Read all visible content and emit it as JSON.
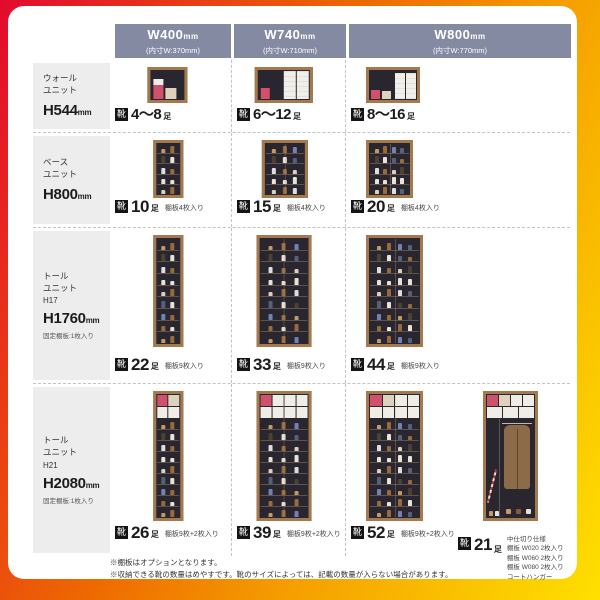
{
  "colors": {
    "frame_red": "#e20a2e",
    "frame_orange": "#ee6a00",
    "frame_yellow": "#ffe000",
    "header_bg": "#858aa3"
  },
  "header": {
    "cols": [
      {
        "title": "W400",
        "title_unit": "mm",
        "inner": "(内寸W:370mm)"
      },
      {
        "title": "W740",
        "title_unit": "mm",
        "inner": "(内寸W:710mm)"
      },
      {
        "title": "W800",
        "title_unit": "mm",
        "inner": "(内寸W:770mm)"
      }
    ]
  },
  "rows": [
    {
      "label": {
        "name": "ウォール\nユニット",
        "code": "",
        "height": "H544",
        "height_unit": "mm",
        "note": ""
      },
      "cells": [
        {
          "badge": "靴",
          "count": "4〜8",
          "count_unit": "足",
          "note": ""
        },
        {
          "badge": "靴",
          "count": "6〜12",
          "count_unit": "足",
          "note": ""
        },
        {
          "badge": "靴",
          "count": "8〜16",
          "count_unit": "足",
          "note": ""
        }
      ]
    },
    {
      "label": {
        "name": "ベース\nユニット",
        "code": "",
        "height": "H800",
        "height_unit": "mm",
        "note": ""
      },
      "cells": [
        {
          "badge": "靴",
          "count": "10",
          "count_unit": "足",
          "note": "棚板4枚入り"
        },
        {
          "badge": "靴",
          "count": "15",
          "count_unit": "足",
          "note": "棚板4枚入り"
        },
        {
          "badge": "靴",
          "count": "20",
          "count_unit": "足",
          "note": "棚板4枚入り"
        }
      ]
    },
    {
      "label": {
        "name": "トール\nユニット",
        "code": "H17",
        "height": "H1760",
        "height_unit": "mm",
        "note": "固定棚板:1枚入り"
      },
      "cells": [
        {
          "badge": "靴",
          "count": "22",
          "count_unit": "足",
          "note": "棚板9枚入り"
        },
        {
          "badge": "靴",
          "count": "33",
          "count_unit": "足",
          "note": "棚板9枚入り"
        },
        {
          "badge": "靴",
          "count": "44",
          "count_unit": "足",
          "note": "棚板9枚入り"
        }
      ]
    },
    {
      "label": {
        "name": "トール\nユニット",
        "code": "H21",
        "height": "H2080",
        "height_unit": "mm",
        "note": "固定棚板:1枚入り"
      },
      "cells": [
        {
          "badge": "靴",
          "count": "26",
          "count_unit": "足",
          "note": "棚板9枚+2枚入り"
        },
        {
          "badge": "靴",
          "count": "39",
          "count_unit": "足",
          "note": "棚板9枚+2枚入り"
        },
        {
          "badge": "靴",
          "count": "52",
          "count_unit": "足",
          "note": "棚板9枚+2枚入り"
        },
        {
          "badge": "靴",
          "count": "21",
          "count_unit": "足",
          "note": "中仕切り仕様\n棚板 W020 2枚入り\n棚板 W060 2枚入り\n棚板 W080 2枚入り\nコートハンガー"
        }
      ]
    }
  ],
  "footnotes": [
    "※棚板はオプションとなります。",
    "※収納できる靴の数量はめやすです。靴のサイズによっては、記載の数量が入らない場合があります。"
  ]
}
